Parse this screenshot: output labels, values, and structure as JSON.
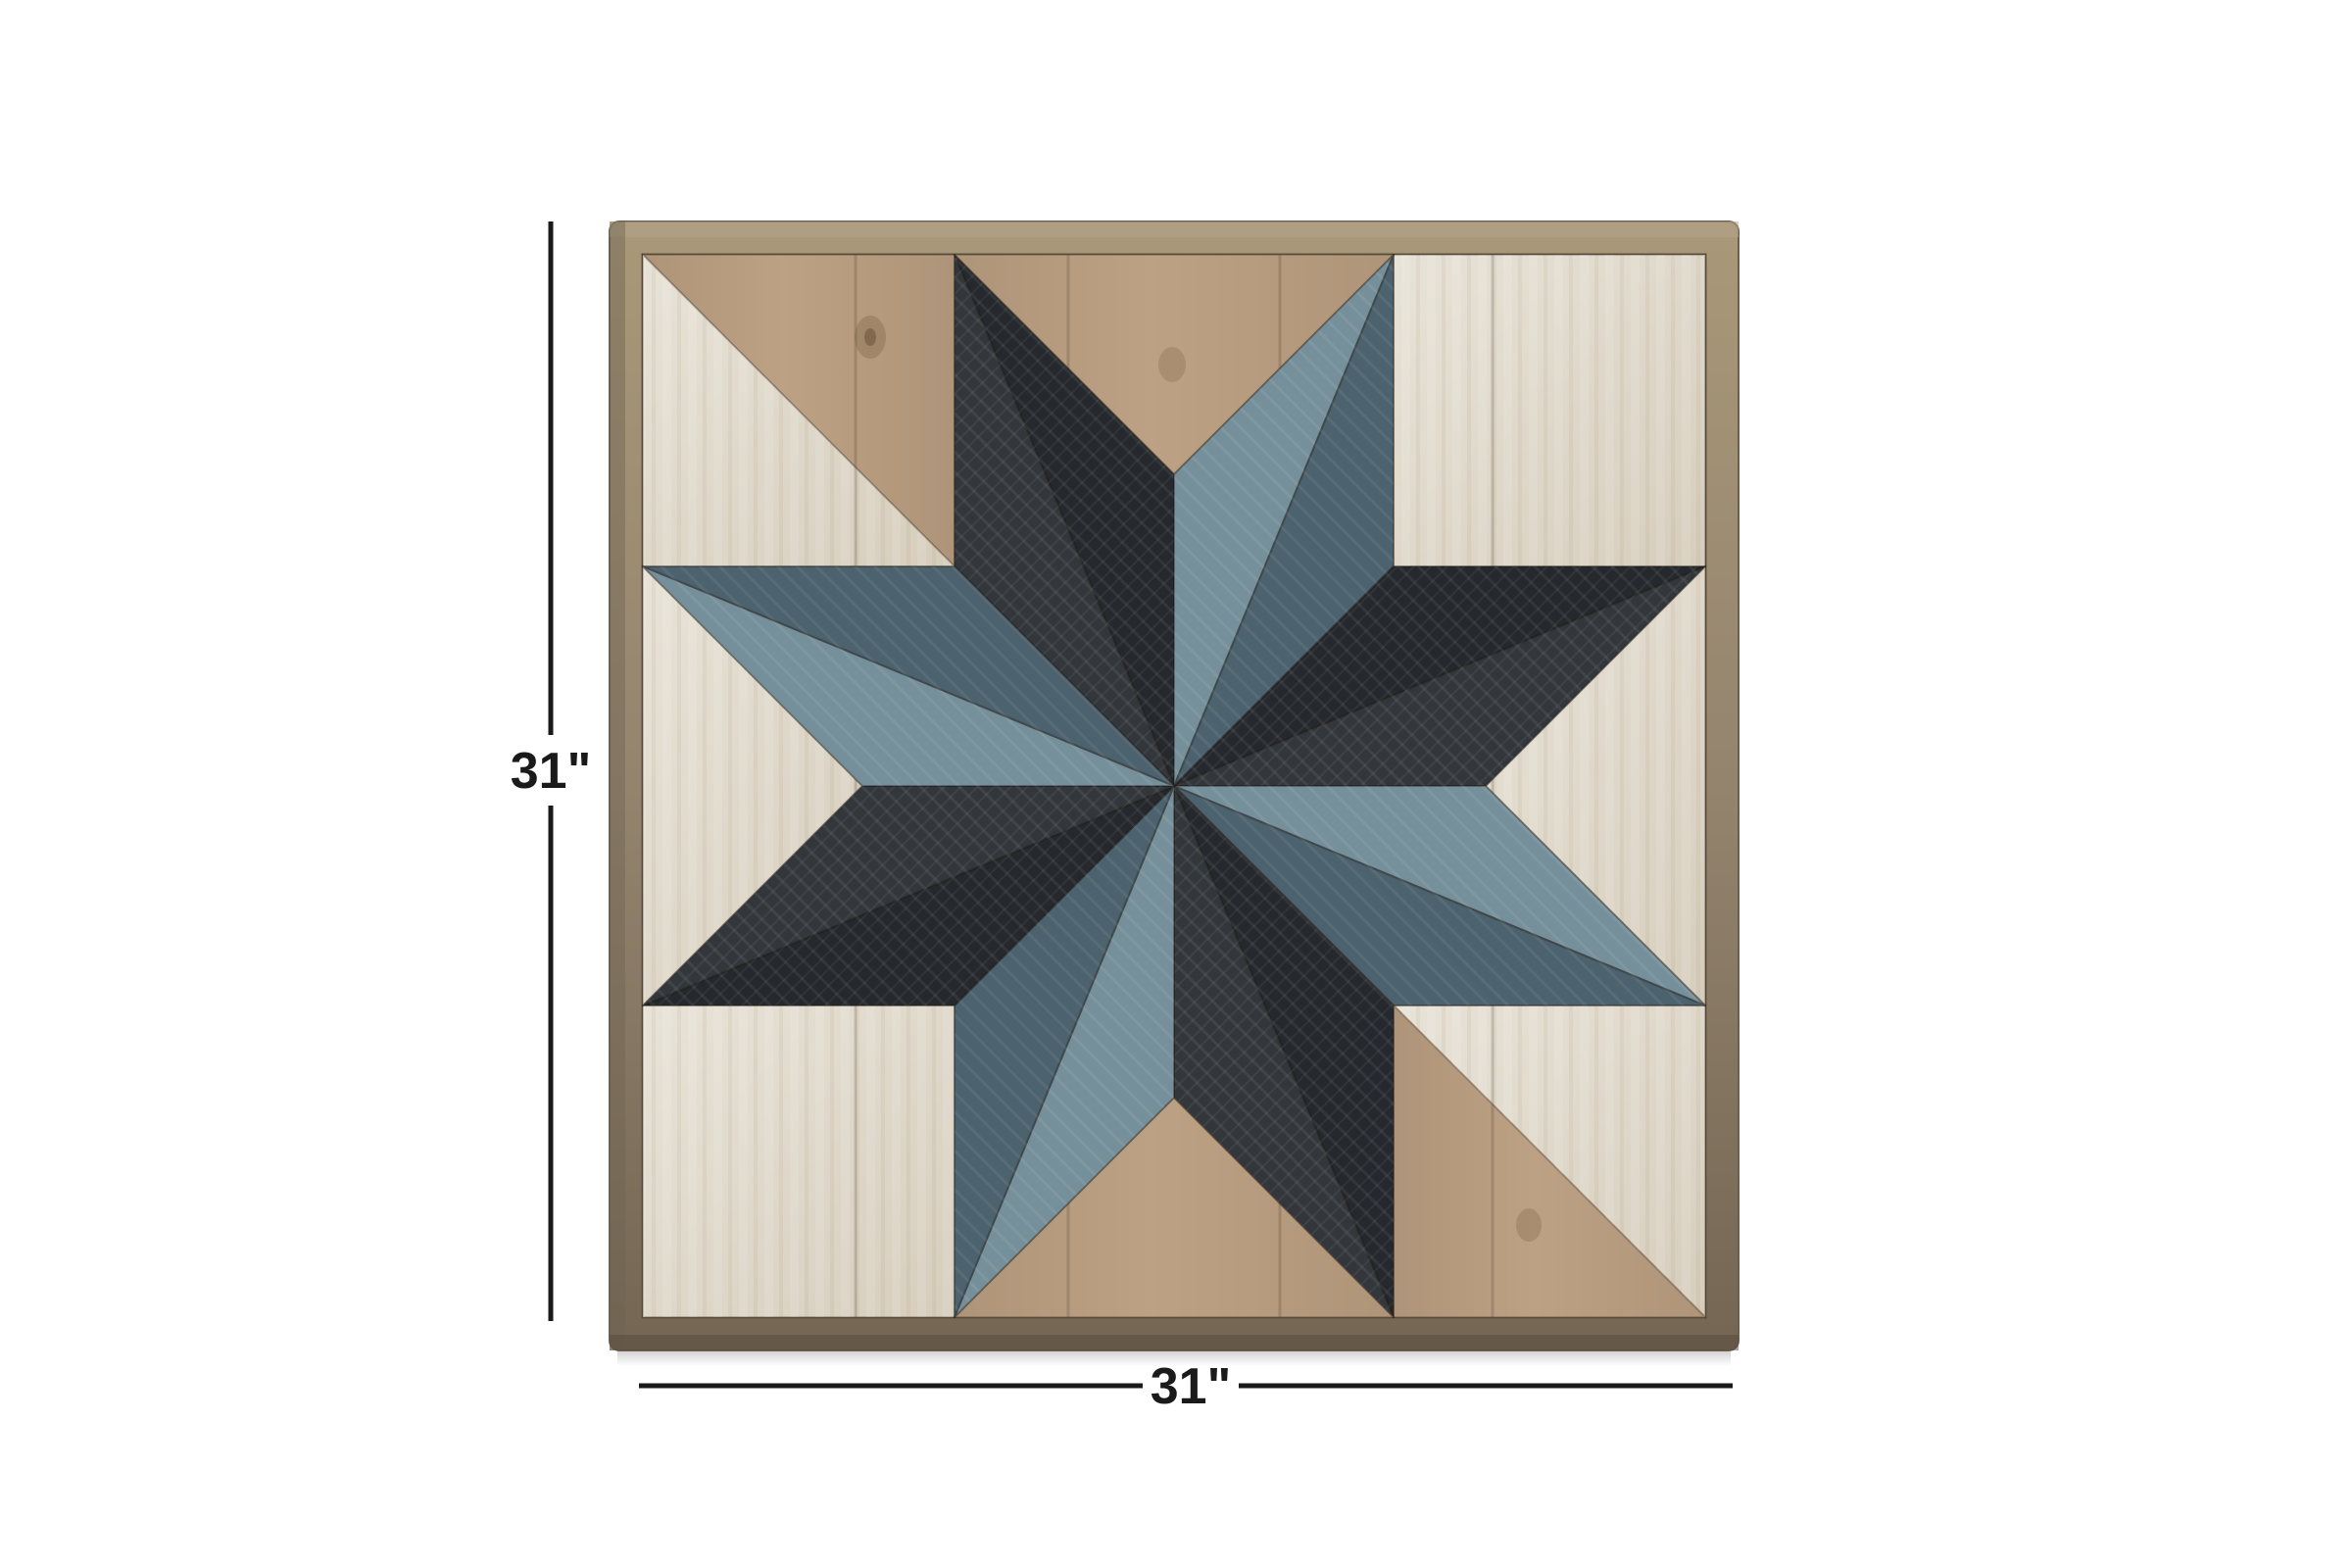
{
  "image": {
    "kind": "product-dimension-photo",
    "subject": "wooden barn quilt star wall art panel"
  },
  "dimensions": {
    "height_label": "31\"",
    "width_label": "31\""
  },
  "colors": {
    "pageBg": "#ffffff",
    "line": "#1a1a1a",
    "frame": "#94846e",
    "frameLight": "#a99878",
    "frameDark": "#746653",
    "frameEdge": "#5e5244",
    "tan": "#ae9478",
    "tanLight": "#bda185",
    "tanDark": "#95805f",
    "white": "#e8e3d8",
    "whiteWarm": "#d6cdbc",
    "black1": "#25282c",
    "black2": "#33373b",
    "blueLight": "#76909b",
    "blueDark": "#4c626e",
    "knot": "#7a6143"
  }
}
